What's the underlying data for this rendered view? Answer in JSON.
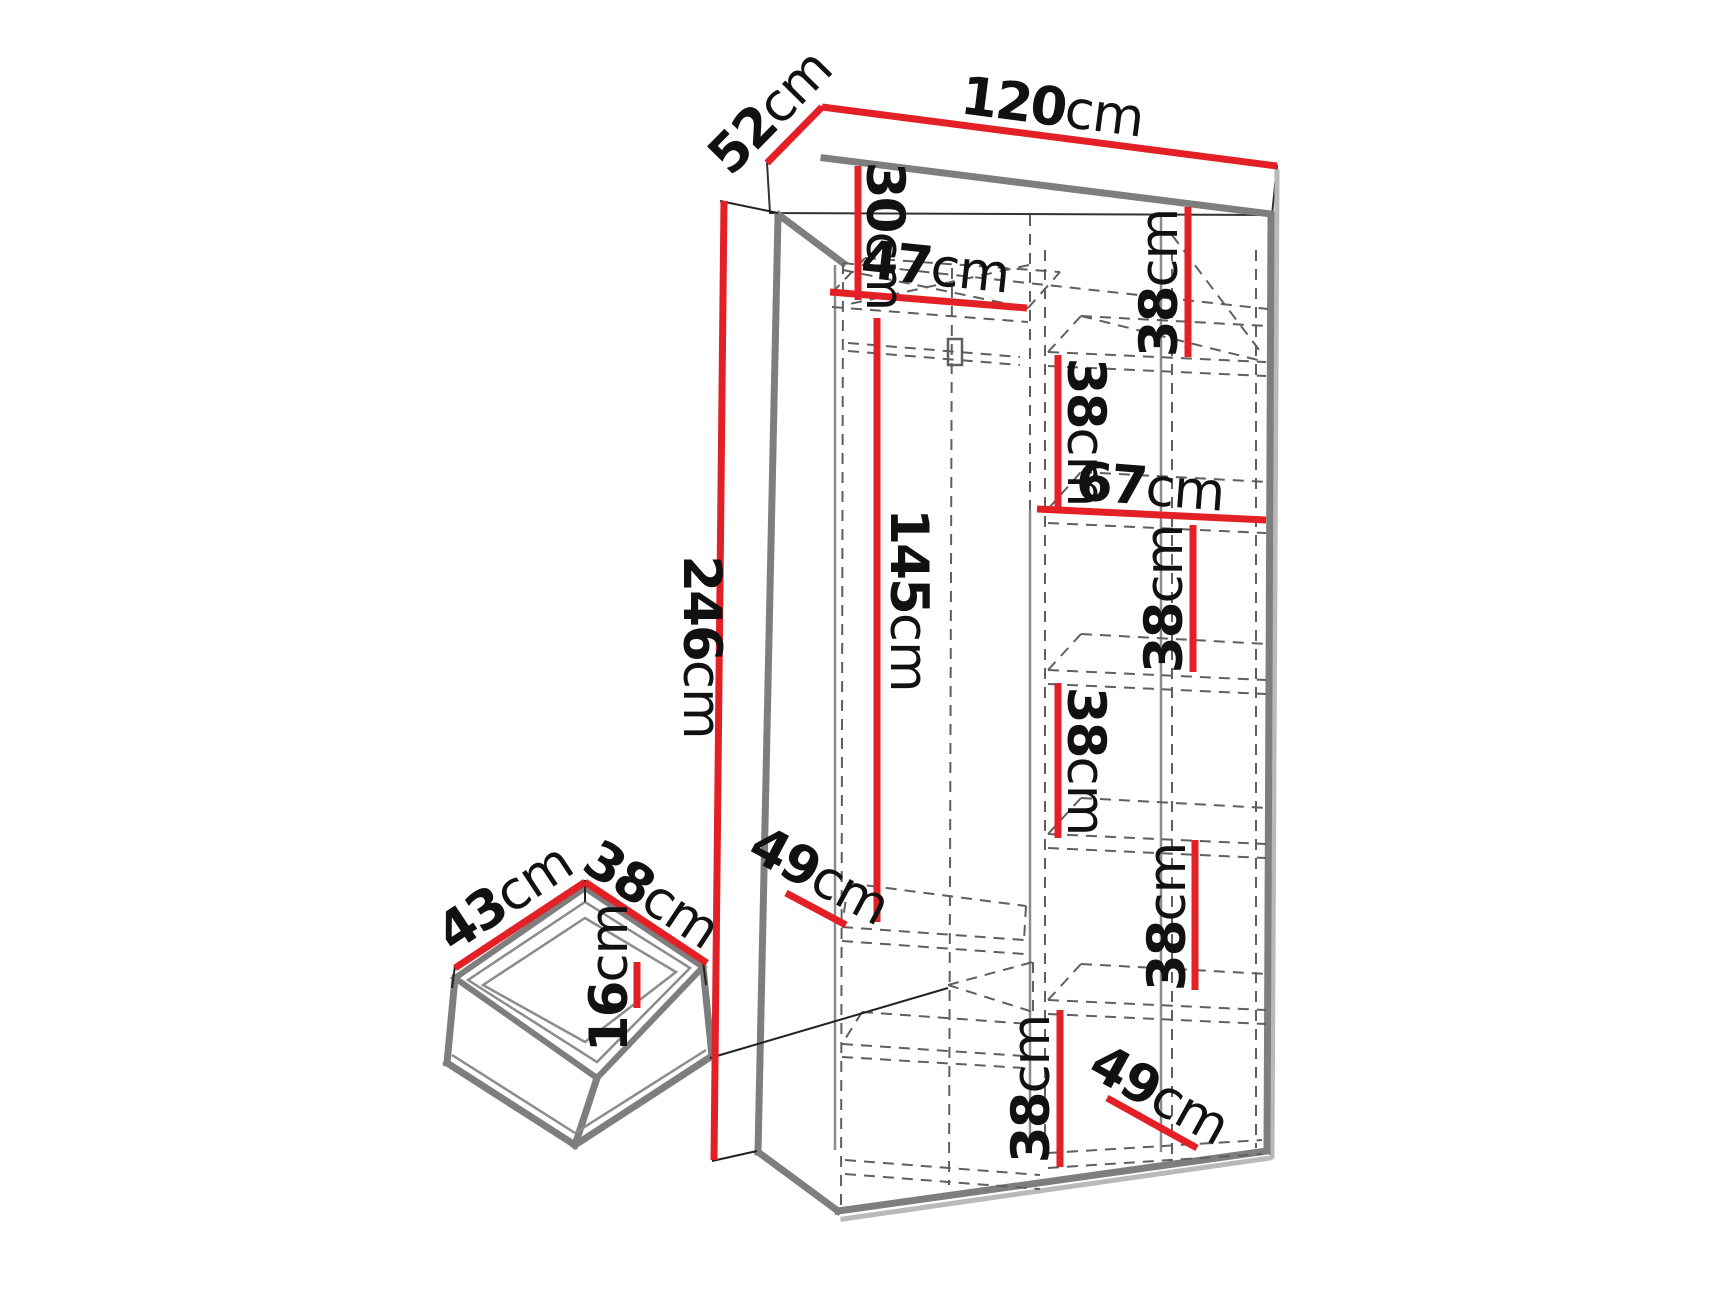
{
  "colors": {
    "accent_red": "#e32025",
    "edge_gray": "#7e7e7e",
    "shadow_gray": "#b9b9b9",
    "inner_gray": "#8c8c8c",
    "dash_gray": "#5f5f5f",
    "label_black": "#111111"
  },
  "unit": "cm",
  "wardrobe": {
    "dimensions": {
      "width": {
        "num": "120",
        "unit": "cm"
      },
      "depth": {
        "num": "52",
        "unit": "cm"
      },
      "height": {
        "num": "246",
        "unit": "cm"
      },
      "top_shelf_drop": {
        "num": "30",
        "unit": "cm"
      },
      "left_section_width": {
        "num": "47",
        "unit": "cm"
      },
      "hanging_space_height": {
        "num": "145",
        "unit": "cm"
      },
      "left_shelf_depth": {
        "num": "49",
        "unit": "cm"
      },
      "right_section_width": {
        "num": "67",
        "unit": "cm"
      },
      "right_shelf_depth": {
        "num": "49",
        "unit": "cm"
      },
      "shelf_gap_1": {
        "num": "38",
        "unit": "cm"
      },
      "shelf_gap_2": {
        "num": "38",
        "unit": "cm"
      },
      "shelf_gap_3": {
        "num": "38",
        "unit": "cm"
      },
      "shelf_gap_4": {
        "num": "38",
        "unit": "cm"
      },
      "shelf_gap_5": {
        "num": "38",
        "unit": "cm"
      },
      "shelf_gap_6": {
        "num": "38",
        "unit": "cm"
      }
    }
  },
  "drawer": {
    "dimensions": {
      "width": {
        "num": "43",
        "unit": "cm"
      },
      "depth": {
        "num": "38",
        "unit": "cm"
      },
      "height": {
        "num": "16",
        "unit": "cm"
      }
    }
  }
}
